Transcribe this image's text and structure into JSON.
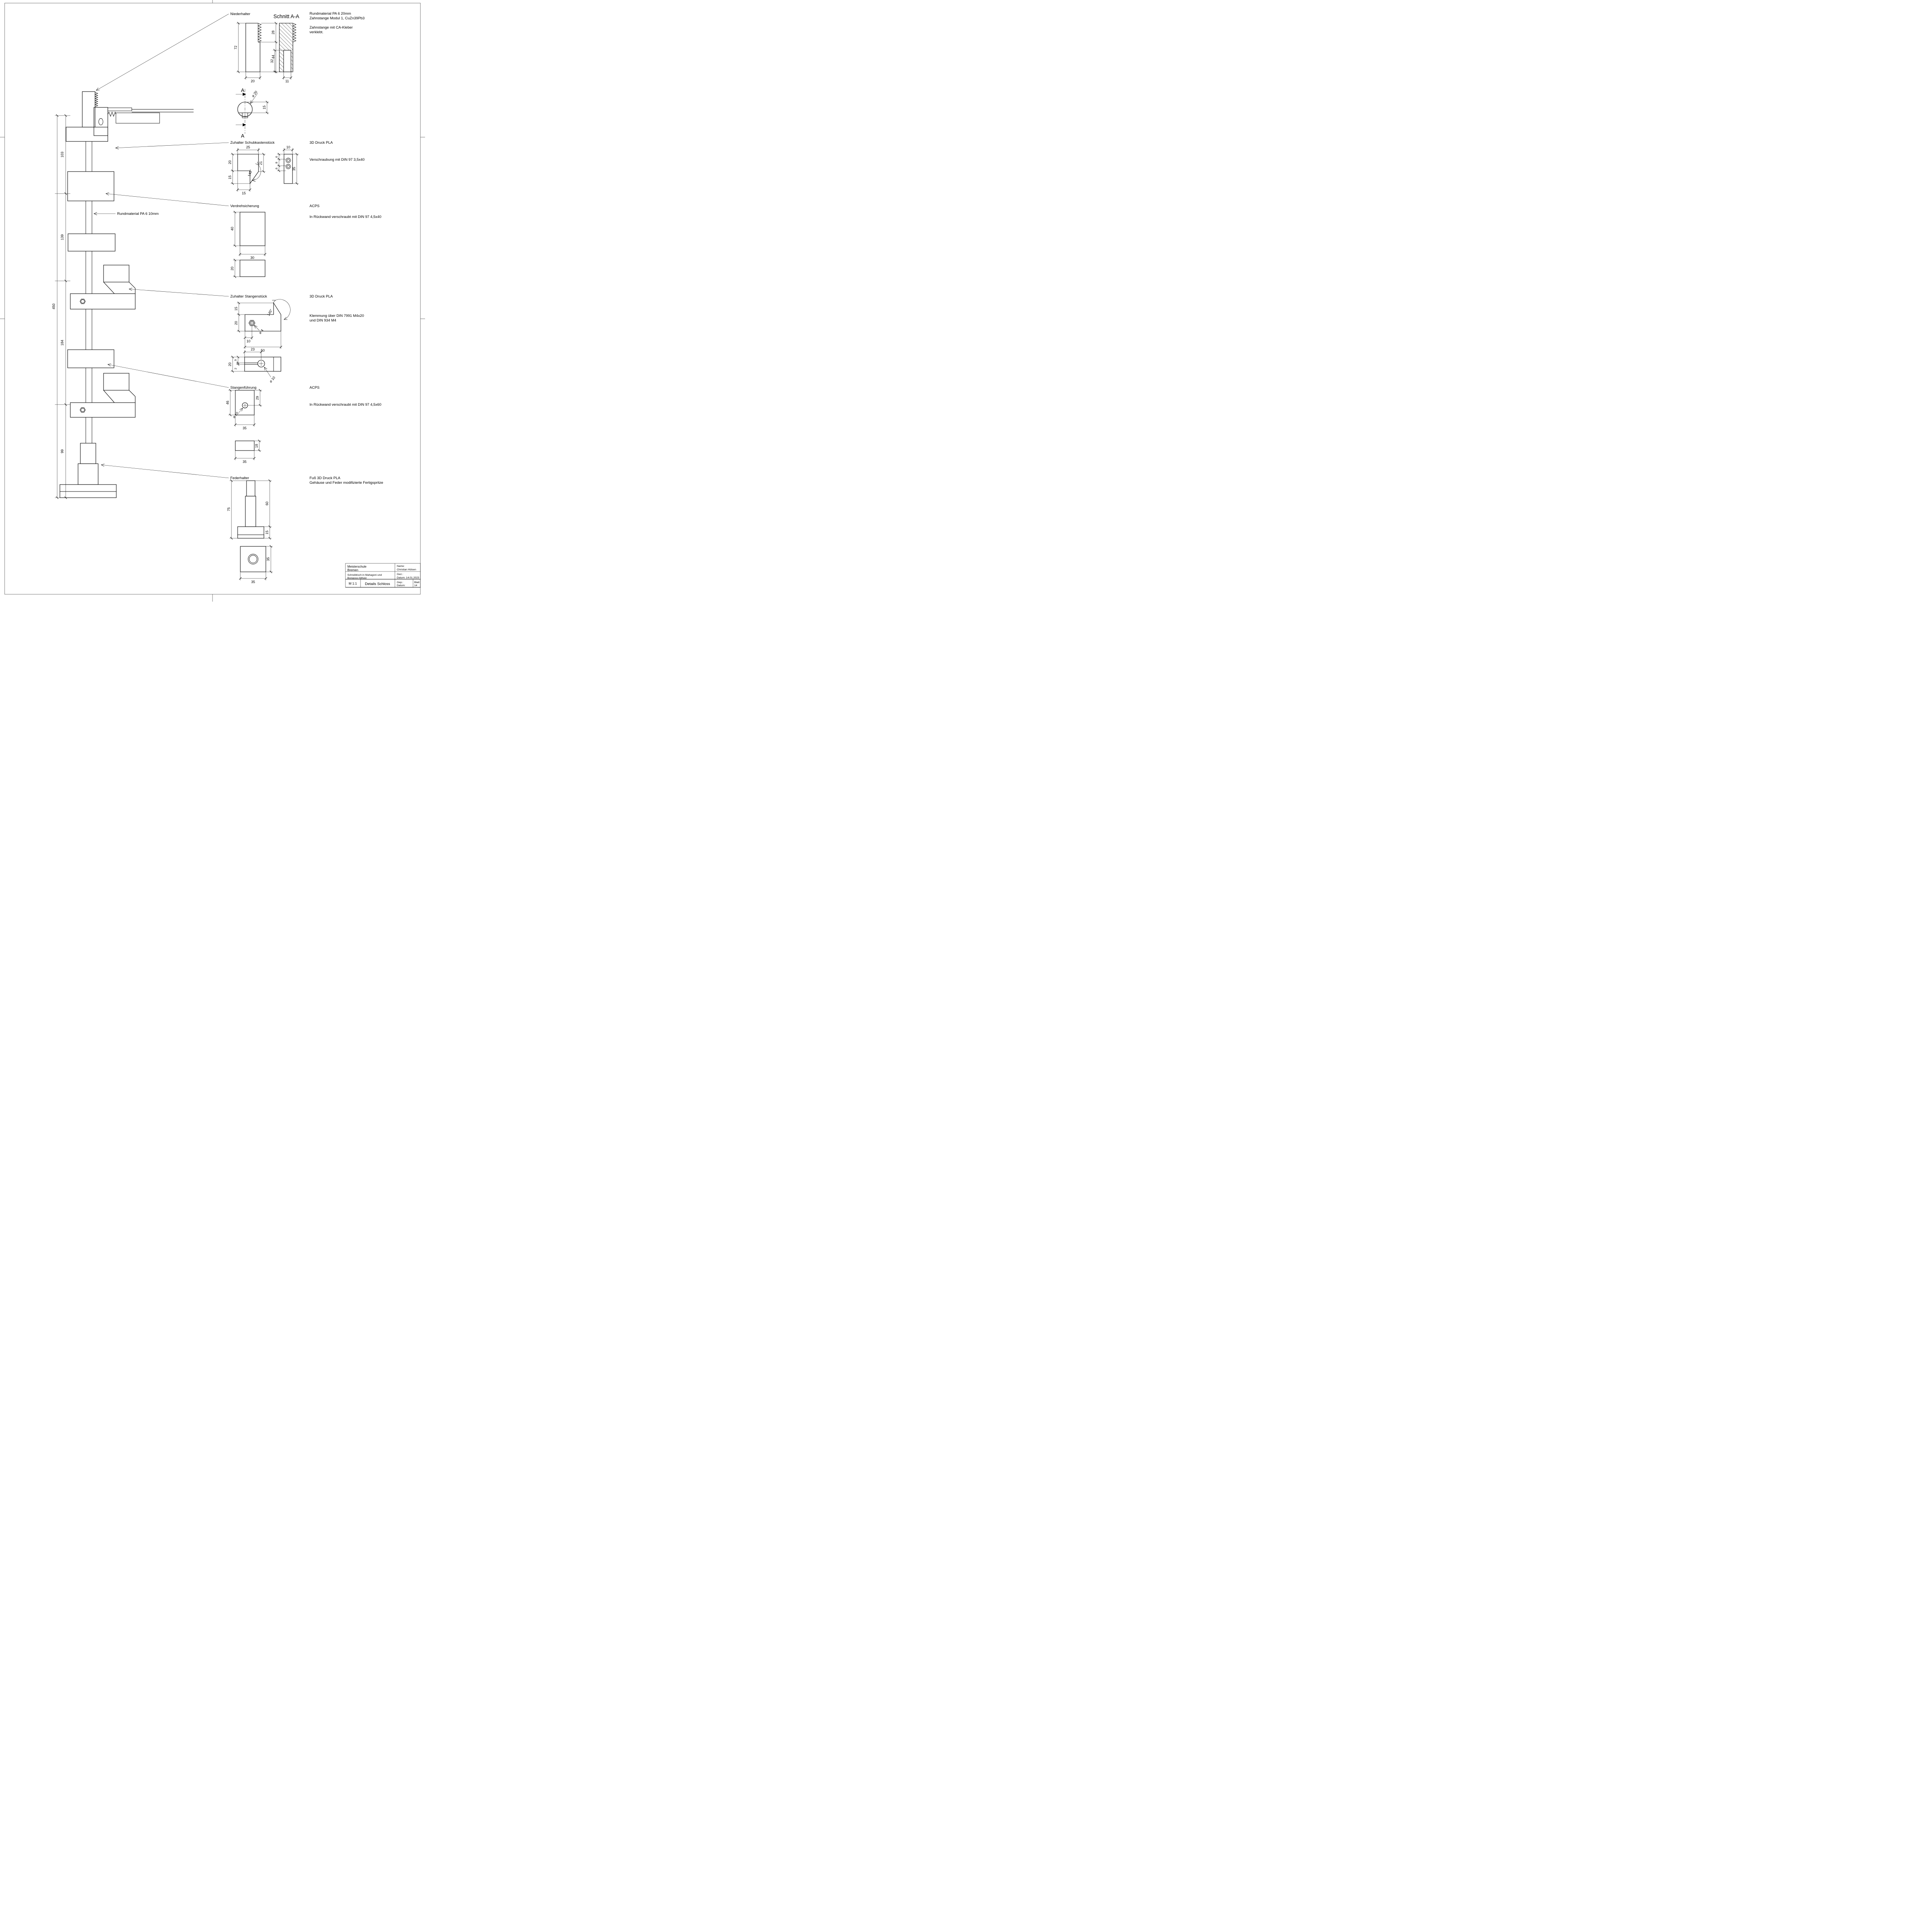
{
  "callouts": {
    "niederhalter": "Niederhalter",
    "schubkasten": "Zuhalter Schubkastenstück",
    "verdreh": "Verdrehsicherung",
    "stangenstueck": "Zuhalter Stangenstück",
    "fuehrung": "Stangenführung",
    "feder": "Federhalter",
    "schnitt": "Schnitt A-A",
    "section_letter": "A"
  },
  "notes": {
    "material_top1": "Rundmaterial PA 6 20mm",
    "material_top2": "Zahnstange Modul 1, CuZn39Pb3",
    "glue1": "Zahnstange mit CA-Kleber",
    "glue2": "verklebt.",
    "rod_callout": "Rundmaterial PA 6 10mm",
    "schubkasten_material": "3D Druck PLA",
    "schubkasten_mount": "Verschraubung mit DIN 97 3,5x40",
    "verdreh_material": "ACPS",
    "verdreh_mount": "In Rückwand verschraubt mit DIN 97 4,5x40",
    "stangenstueck_material": "3D Druck PLA",
    "stangenstueck_mount1": "Klemmung über DIN 7991 M4x20",
    "stangenstueck_mount2": "und DIN 934 M4",
    "fuehrung_material": "ACPS",
    "fuehrung_mount": "In Rückwand verschraubt mit DIN 97 4,5x60",
    "feder_material1": "Fuß 3D Druck PLA",
    "feder_material2": "Gehäuse und Feder modifizierte Fertigspritze"
  },
  "dims": {
    "niederhalter": {
      "h": "72",
      "rack": "28",
      "lower": "44",
      "w": "20",
      "pocket": "32",
      "pocket_w": "11",
      "dia": "⌀ 20",
      "flat": "15"
    },
    "schubkasten": {
      "w": "25",
      "h1": "20",
      "h2": "15",
      "right": "21",
      "angle": "145°",
      "bottom": "15",
      "side_w": "10",
      "side_h": "35",
      "s1": "6",
      "s2": "8",
      "s3": "6"
    },
    "verdreh": {
      "h": "40",
      "w": "30",
      "h2": "20"
    },
    "stangenstueck": {
      "tooth": "15",
      "h": "20",
      "nut_x": "10",
      "len": "50",
      "angle": "145°",
      "dia": "⌀ 4",
      "plan_w": "23",
      "p1": "9",
      "p2": "2",
      "p3": "20",
      "dia2": "⌀ 10"
    },
    "fuehrung": {
      "h": "46",
      "to_hole": "29",
      "w": "35",
      "dia": "⌀ 10",
      "plate_h": "18",
      "plate_w": "35"
    },
    "feder": {
      "h": "75",
      "rod": "60",
      "base": "15",
      "sq_h": "35",
      "sq_w": "35"
    },
    "chain": {
      "d1": "103",
      "d2": "139",
      "d3": "184",
      "d4": "99",
      "total": "450"
    }
  },
  "titleblock": {
    "school1": "Meisterschule",
    "school2": "Bremen",
    "name_label": "Name:",
    "name": "Christian Hülsen",
    "project1": "Schreibtisch in Mahagoni und",
    "project2": "Bongossi Altholz",
    "gez_label": "Gez.:",
    "gez_date": "Datum: 14.01.2023",
    "scale": "M 1:1",
    "title": "Details Schloss",
    "gep_label": "Gep.:",
    "gep_date": "Datum:",
    "sheet_label": "Blatt",
    "sheet_no": "14"
  }
}
